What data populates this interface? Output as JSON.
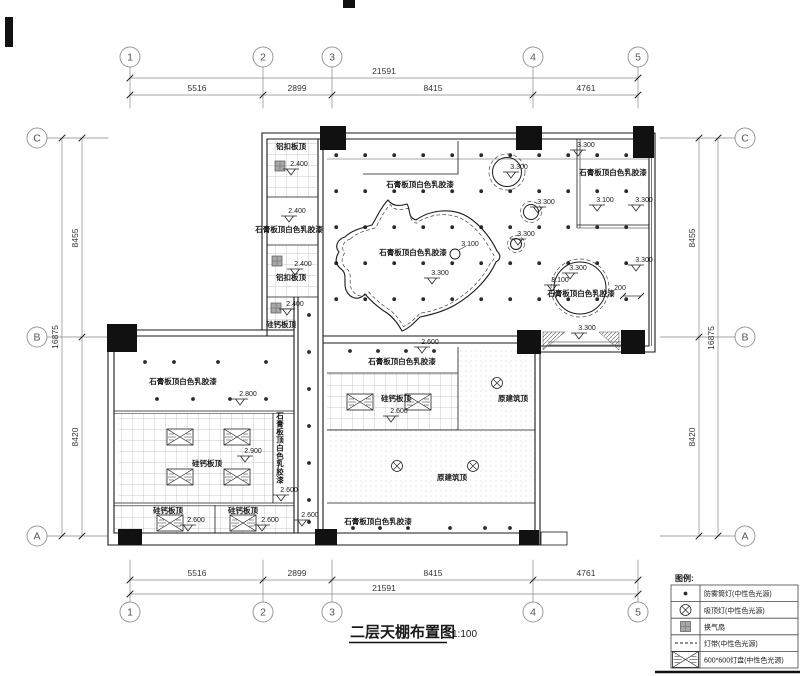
{
  "title": {
    "text": "二层天棚布置图",
    "scale": "1:100"
  },
  "axis": {
    "cols": [
      "1",
      "2",
      "3",
      "4",
      "5"
    ],
    "rows": [
      "C",
      "B",
      "A"
    ],
    "col_dims": [
      "5516",
      "2899",
      "8415",
      "4761"
    ],
    "col_total": "21591",
    "row_dims": [
      "8455",
      "8420"
    ],
    "row_total": "16875",
    "gap_dim": "200"
  },
  "ceilings": {
    "gypsum": "石膏板顶白色乳胶漆",
    "aluminum": "铝扣板顶",
    "silicate": "硅钙板顶",
    "original": "原建筑顶"
  },
  "elevations": {
    "e2400": "2.400",
    "e2600": "2.600",
    "e2800": "2.800",
    "e2900": "2.900",
    "e3100": "3.100",
    "e3300": "3.300"
  },
  "legend": {
    "title": "图例:",
    "items": [
      {
        "icon": "downlight-icon",
        "label": "防雾筒灯(中性色光源)"
      },
      {
        "icon": "ceiling-lamp-icon",
        "label": "吸顶灯(中性色光源)"
      },
      {
        "icon": "vent-fan-icon",
        "label": "换气扇"
      },
      {
        "icon": "light-strip-icon",
        "label": "灯带(中性色光源)"
      },
      {
        "icon": "light-panel-icon",
        "label": "600*600灯盘(中性色光源)"
      }
    ]
  }
}
